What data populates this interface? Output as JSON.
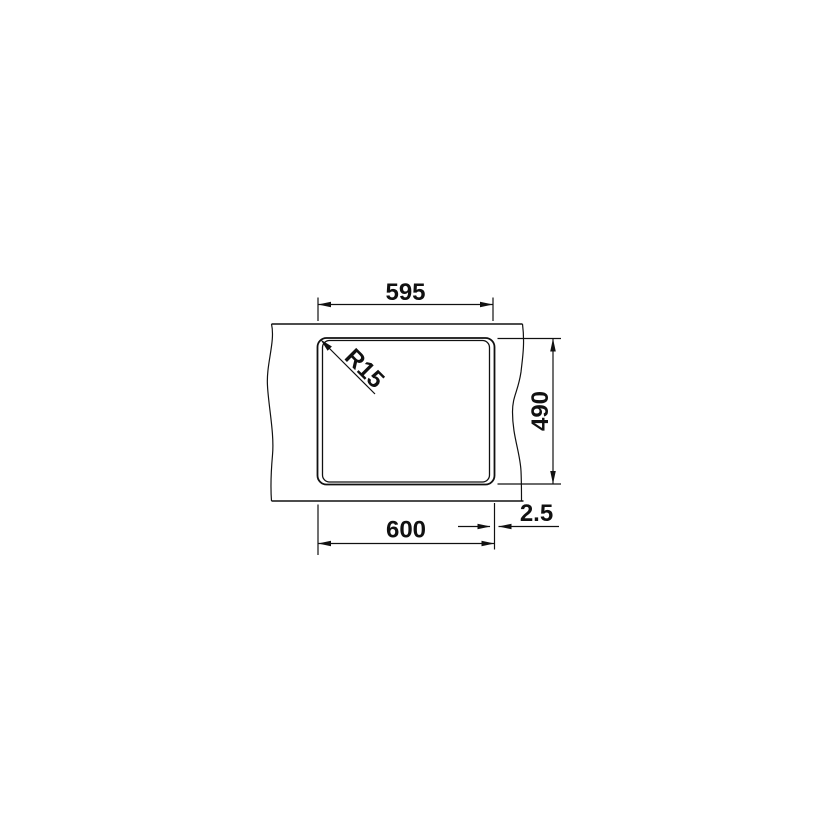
{
  "drawing": {
    "type": "sink-cutout-installation-drawing",
    "labels": {
      "width_cutout": "595",
      "width_overall": "600",
      "depth": "490",
      "edge_offset": "2.5",
      "corner_radius": "R15"
    },
    "colors": {
      "line": "#111111",
      "background": "#ffffff"
    }
  }
}
